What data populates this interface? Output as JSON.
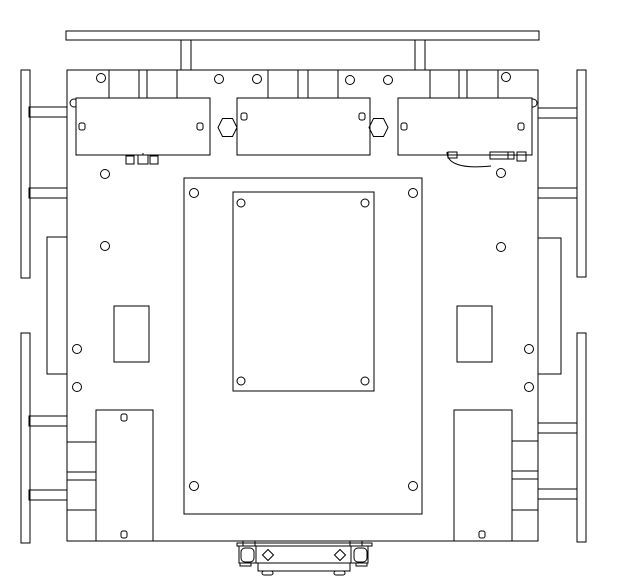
{
  "canvas": {
    "width": 618,
    "height": 579,
    "viewBox": "0 0 618 579",
    "background": "#ffffff",
    "stroke": "#000000",
    "stroke_width": 1
  },
  "drawing": {
    "shapes": [
      {
        "type": "rect",
        "name": "top-bumper-bar",
        "x": 66,
        "y": 31,
        "w": 473,
        "h": 9
      },
      {
        "type": "rect",
        "name": "bumper-post-left",
        "x": 181,
        "y": 40,
        "w": 10,
        "h": 30
      },
      {
        "type": "rect",
        "name": "bumper-post-right",
        "x": 415,
        "y": 40,
        "w": 10,
        "h": 30
      },
      {
        "type": "rect",
        "name": "wheel-rail-left-front",
        "x": 21,
        "y": 70,
        "w": 9,
        "h": 208
      },
      {
        "type": "rect",
        "name": "wheel-rail-left-rear",
        "x": 21,
        "y": 333,
        "w": 9,
        "h": 210
      },
      {
        "type": "rect",
        "name": "wheel-rail-right-front",
        "x": 577,
        "y": 70,
        "w": 9,
        "h": 207
      },
      {
        "type": "rect",
        "name": "wheel-rail-right-rear",
        "x": 577,
        "y": 333,
        "w": 9,
        "h": 209
      },
      {
        "type": "rect",
        "name": "mount-arm-left-1",
        "x": 29,
        "y": 107,
        "w": 38,
        "h": 10
      },
      {
        "type": "rect",
        "name": "mount-arm-left-2",
        "x": 29,
        "y": 188,
        "w": 38,
        "h": 10
      },
      {
        "type": "rect",
        "name": "mount-arm-left-3",
        "x": 29,
        "y": 416,
        "w": 38,
        "h": 10
      },
      {
        "type": "rect",
        "name": "mount-arm-left-4",
        "x": 29,
        "y": 490,
        "w": 38,
        "h": 10
      },
      {
        "type": "rect",
        "name": "mount-arm-right-1",
        "x": 538,
        "y": 108,
        "w": 39,
        "h": 10
      },
      {
        "type": "rect",
        "name": "mount-arm-right-2",
        "x": 538,
        "y": 188,
        "w": 39,
        "h": 10
      },
      {
        "type": "rect",
        "name": "mount-arm-right-3",
        "x": 538,
        "y": 423,
        "w": 39,
        "h": 10
      },
      {
        "type": "rect",
        "name": "mount-arm-right-4",
        "x": 538,
        "y": 489,
        "w": 39,
        "h": 10
      },
      {
        "type": "rect",
        "name": "side-pocket-left",
        "x": 47,
        "y": 237,
        "w": 20,
        "h": 137
      },
      {
        "type": "rect",
        "name": "side-pocket-right",
        "x": 538,
        "y": 238,
        "w": 23,
        "h": 136
      },
      {
        "type": "rect",
        "name": "main-plate",
        "x": 67,
        "y": 70,
        "w": 471,
        "h": 471,
        "fill": "#ffffff"
      },
      {
        "type": "circle",
        "name": "corner-hole-under-left-module",
        "cx": 74,
        "cy": 103,
        "r": 4
      },
      {
        "type": "rect",
        "name": "module-left",
        "x": 76,
        "y": 98,
        "w": 134,
        "h": 57,
        "fill": "#ffffff"
      },
      {
        "type": "circle",
        "name": "corner-hole-under-right-module",
        "cx": 533,
        "cy": 103,
        "r": 4
      },
      {
        "type": "rect",
        "name": "module-right",
        "x": 398,
        "y": 98,
        "w": 134,
        "h": 57,
        "fill": "#ffffff"
      },
      {
        "type": "rect",
        "name": "module-center",
        "x": 237,
        "y": 98,
        "w": 133,
        "h": 57,
        "fill": "#ffffff"
      },
      {
        "type": "rect",
        "name": "module-left-hole-a",
        "x": 79,
        "y": 123,
        "w": 6,
        "h": 7,
        "rx": 2
      },
      {
        "type": "rect",
        "name": "module-left-hole-b",
        "x": 197,
        "y": 123,
        "w": 6,
        "h": 7,
        "rx": 2
      },
      {
        "type": "rect",
        "name": "module-center-hole-a",
        "x": 241,
        "y": 113,
        "w": 6,
        "h": 7,
        "rx": 2
      },
      {
        "type": "rect",
        "name": "module-center-hole-b",
        "x": 359,
        "y": 113,
        "w": 6,
        "h": 7,
        "rx": 2
      },
      {
        "type": "rect",
        "name": "module-right-hole-a",
        "x": 401,
        "y": 123,
        "w": 6,
        "h": 7,
        "rx": 2
      },
      {
        "type": "rect",
        "name": "module-right-hole-b",
        "x": 518,
        "y": 123,
        "w": 6,
        "h": 7,
        "rx": 2
      },
      {
        "type": "polygon",
        "name": "hex-standoff-left",
        "points": "218,127.5 222.5,118.5 232.5,118.5 237,127.5 232.5,136.5 222.5,136.5"
      },
      {
        "type": "polygon",
        "name": "hex-standoff-right",
        "points": "369,127.5 373.5,118.5 383.5,118.5 388,127.5 383.5,136.5 373.5,136.5"
      },
      {
        "type": "line",
        "name": "edge-tab-line",
        "x1": 109,
        "y1": 70,
        "x2": 109,
        "y2": 98
      },
      {
        "type": "line",
        "name": "edge-tab-line",
        "x1": 139,
        "y1": 70,
        "x2": 139,
        "y2": 98
      },
      {
        "type": "line",
        "name": "edge-tab-line",
        "x1": 147,
        "y1": 70,
        "x2": 147,
        "y2": 98
      },
      {
        "type": "line",
        "name": "edge-tab-line",
        "x1": 177,
        "y1": 70,
        "x2": 177,
        "y2": 98
      },
      {
        "type": "line",
        "name": "edge-tab-line",
        "x1": 268,
        "y1": 70,
        "x2": 268,
        "y2": 98
      },
      {
        "type": "line",
        "name": "edge-tab-line",
        "x1": 298,
        "y1": 70,
        "x2": 298,
        "y2": 98
      },
      {
        "type": "line",
        "name": "edge-tab-line",
        "x1": 308,
        "y1": 70,
        "x2": 308,
        "y2": 98
      },
      {
        "type": "line",
        "name": "edge-tab-line",
        "x1": 338,
        "y1": 70,
        "x2": 338,
        "y2": 98
      },
      {
        "type": "line",
        "name": "edge-tab-line",
        "x1": 430,
        "y1": 70,
        "x2": 430,
        "y2": 98
      },
      {
        "type": "line",
        "name": "edge-tab-line",
        "x1": 459,
        "y1": 70,
        "x2": 459,
        "y2": 98
      },
      {
        "type": "line",
        "name": "edge-tab-line",
        "x1": 467,
        "y1": 70,
        "x2": 467,
        "y2": 98
      },
      {
        "type": "line",
        "name": "edge-tab-line",
        "x1": 498,
        "y1": 70,
        "x2": 498,
        "y2": 98
      },
      {
        "type": "circle",
        "name": "plate-hole",
        "cx": 101,
        "cy": 78,
        "r": 4.5
      },
      {
        "type": "circle",
        "name": "plate-hole",
        "cx": 219,
        "cy": 79,
        "r": 4.5
      },
      {
        "type": "circle",
        "name": "plate-hole",
        "cx": 257,
        "cy": 79,
        "r": 4.5
      },
      {
        "type": "circle",
        "name": "plate-hole",
        "cx": 350,
        "cy": 80,
        "r": 4.5
      },
      {
        "type": "circle",
        "name": "plate-hole",
        "cx": 388,
        "cy": 80,
        "r": 4.5
      },
      {
        "type": "circle",
        "name": "plate-hole",
        "cx": 506,
        "cy": 77,
        "r": 4.5
      },
      {
        "type": "circle",
        "name": "plate-hole",
        "cx": 105,
        "cy": 174,
        "r": 4.5
      },
      {
        "type": "circle",
        "name": "plate-hole",
        "cx": 501,
        "cy": 173,
        "r": 4.5
      },
      {
        "type": "circle",
        "name": "plate-hole",
        "cx": 105,
        "cy": 246,
        "r": 4.5
      },
      {
        "type": "circle",
        "name": "plate-hole",
        "cx": 501,
        "cy": 247,
        "r": 4.5
      },
      {
        "type": "circle",
        "name": "plate-hole",
        "cx": 77,
        "cy": 349,
        "r": 4.5
      },
      {
        "type": "circle",
        "name": "plate-hole",
        "cx": 77,
        "cy": 387,
        "r": 4.5
      },
      {
        "type": "circle",
        "name": "plate-hole",
        "cx": 529,
        "cy": 349,
        "r": 4.5
      },
      {
        "type": "circle",
        "name": "plate-hole",
        "cx": 529,
        "cy": 387,
        "r": 4.5
      },
      {
        "type": "rect",
        "name": "center-bay-outline",
        "x": 184,
        "y": 178,
        "w": 238,
        "h": 336
      },
      {
        "type": "rect",
        "name": "center-cutout",
        "x": 233,
        "y": 192,
        "w": 141,
        "h": 199
      },
      {
        "type": "circle",
        "name": "cutout-corner-hole",
        "cx": 241,
        "cy": 203,
        "r": 4
      },
      {
        "type": "circle",
        "name": "cutout-corner-hole",
        "cx": 365,
        "cy": 203,
        "r": 4
      },
      {
        "type": "circle",
        "name": "cutout-corner-hole",
        "cx": 241,
        "cy": 381,
        "r": 4
      },
      {
        "type": "circle",
        "name": "cutout-corner-hole",
        "cx": 365,
        "cy": 381,
        "r": 4
      },
      {
        "type": "circle",
        "name": "bay-corner-hole",
        "cx": 194,
        "cy": 193,
        "r": 4.5
      },
      {
        "type": "circle",
        "name": "bay-corner-hole",
        "cx": 413,
        "cy": 193,
        "r": 4.5
      },
      {
        "type": "circle",
        "name": "bay-corner-hole",
        "cx": 194,
        "cy": 486,
        "r": 4.5
      },
      {
        "type": "circle",
        "name": "bay-corner-hole",
        "cx": 413,
        "cy": 486,
        "r": 4.5
      },
      {
        "type": "rect",
        "name": "mid-slot-left",
        "x": 114,
        "y": 306,
        "w": 35,
        "h": 56
      },
      {
        "type": "rect",
        "name": "mid-slot-right",
        "x": 457,
        "y": 306,
        "w": 35,
        "h": 56
      },
      {
        "type": "rect",
        "name": "battery-box-left",
        "x": 96,
        "y": 410,
        "w": 57,
        "h": 131
      },
      {
        "type": "rect",
        "name": "battery-box-right",
        "x": 454,
        "y": 410,
        "w": 58,
        "h": 131
      },
      {
        "type": "rect",
        "name": "battery-hole",
        "x": 121,
        "y": 414,
        "w": 6,
        "h": 7,
        "rx": 2
      },
      {
        "type": "rect",
        "name": "battery-hole",
        "x": 121,
        "y": 531,
        "w": 6,
        "h": 7,
        "rx": 2
      },
      {
        "type": "rect",
        "name": "battery-hole",
        "x": 479,
        "y": 531,
        "w": 6,
        "h": 7,
        "rx": 2
      },
      {
        "type": "rect",
        "name": "edge-block-left",
        "x": 67,
        "y": 442,
        "w": 29,
        "h": 30
      },
      {
        "type": "rect",
        "name": "edge-block-left",
        "x": 67,
        "y": 480,
        "w": 29,
        "h": 30
      },
      {
        "type": "rect",
        "name": "edge-block-left",
        "x": 67,
        "y": 510,
        "w": 29,
        "h": 31
      },
      {
        "type": "rect",
        "name": "edge-block-right",
        "x": 512,
        "y": 441,
        "w": 26,
        "h": 30
      },
      {
        "type": "rect",
        "name": "edge-block-right",
        "x": 512,
        "y": 479,
        "w": 26,
        "h": 31
      },
      {
        "type": "rect",
        "name": "edge-block-right",
        "x": 512,
        "y": 510,
        "w": 26,
        "h": 31
      },
      {
        "type": "rect",
        "name": "wire-clip",
        "x": 126,
        "y": 156,
        "w": 8,
        "h": 8
      },
      {
        "type": "rect",
        "name": "wire-clip",
        "x": 138,
        "y": 155,
        "w": 10,
        "h": 9
      },
      {
        "type": "rect",
        "name": "wire-clip",
        "x": 150,
        "y": 156,
        "w": 8,
        "h": 8
      },
      {
        "type": "line",
        "name": "wire-clip-pin",
        "x1": 143,
        "y1": 153,
        "x2": 143,
        "y2": 155
      },
      {
        "type": "rect",
        "name": "terminal-clip",
        "x": 448,
        "y": 152,
        "w": 9,
        "h": 6
      },
      {
        "type": "path",
        "name": "motor-wire-arc",
        "d": "M447,152 C447,164 462,169 491,166"
      },
      {
        "type": "rect",
        "name": "terminal-strip",
        "x": 490,
        "y": 152,
        "w": 24,
        "h": 7
      },
      {
        "type": "line",
        "name": "terminal-strip-divider",
        "x1": 508,
        "y1": 152,
        "x2": 508,
        "y2": 159
      },
      {
        "type": "rect",
        "name": "terminal-clip",
        "x": 517,
        "y": 152,
        "w": 9,
        "h": 9
      },
      {
        "type": "rect",
        "name": "caster-flange",
        "x": 237,
        "y": 543,
        "w": 135,
        "h": 3
      },
      {
        "type": "line",
        "name": "caster-flange-tick",
        "x1": 243,
        "y1": 541,
        "x2": 243,
        "y2": 546
      },
      {
        "type": "line",
        "name": "caster-flange-tick",
        "x1": 255,
        "y1": 541,
        "x2": 255,
        "y2": 546
      },
      {
        "type": "line",
        "name": "caster-flange-tick",
        "x1": 350,
        "y1": 541,
        "x2": 350,
        "y2": 546
      },
      {
        "type": "line",
        "name": "caster-flange-tick",
        "x1": 362,
        "y1": 541,
        "x2": 362,
        "y2": 546
      },
      {
        "type": "rect",
        "name": "caster-body",
        "x": 239,
        "y": 546,
        "w": 129,
        "h": 17
      },
      {
        "type": "line",
        "name": "caster-body-divider",
        "x1": 256,
        "y1": 546,
        "x2": 256,
        "y2": 563
      },
      {
        "type": "line",
        "name": "caster-body-divider",
        "x1": 351,
        "y1": 546,
        "x2": 351,
        "y2": 563
      },
      {
        "type": "rect",
        "name": "caster-bushing-left",
        "x": 241,
        "y": 548,
        "w": 13,
        "h": 14,
        "rx": 4
      },
      {
        "type": "rect",
        "name": "caster-bushing-right",
        "x": 354,
        "y": 548,
        "w": 13,
        "h": 14,
        "rx": 4
      },
      {
        "type": "polygon",
        "name": "caster-diamond-hole-left",
        "points": "268,549.5 273.5,555 268,560.5 262.5,555"
      },
      {
        "type": "polygon",
        "name": "caster-diamond-hole-right",
        "points": "340,549.5 345.5,555 340,560.5 334.5,555"
      },
      {
        "type": "rect",
        "name": "caster-lower-bar",
        "x": 258,
        "y": 563,
        "w": 92,
        "h": 8
      },
      {
        "type": "rect",
        "name": "caster-side-tab",
        "x": 240,
        "y": 563,
        "w": 11,
        "h": 3
      },
      {
        "type": "rect",
        "name": "caster-side-tab",
        "x": 356,
        "y": 563,
        "w": 11,
        "h": 3
      },
      {
        "type": "rect",
        "name": "caster-foot",
        "x": 262,
        "y": 571,
        "w": 11,
        "h": 4,
        "rx": 2
      },
      {
        "type": "rect",
        "name": "caster-foot",
        "x": 334,
        "y": 571,
        "w": 11,
        "h": 4,
        "rx": 2
      }
    ]
  }
}
